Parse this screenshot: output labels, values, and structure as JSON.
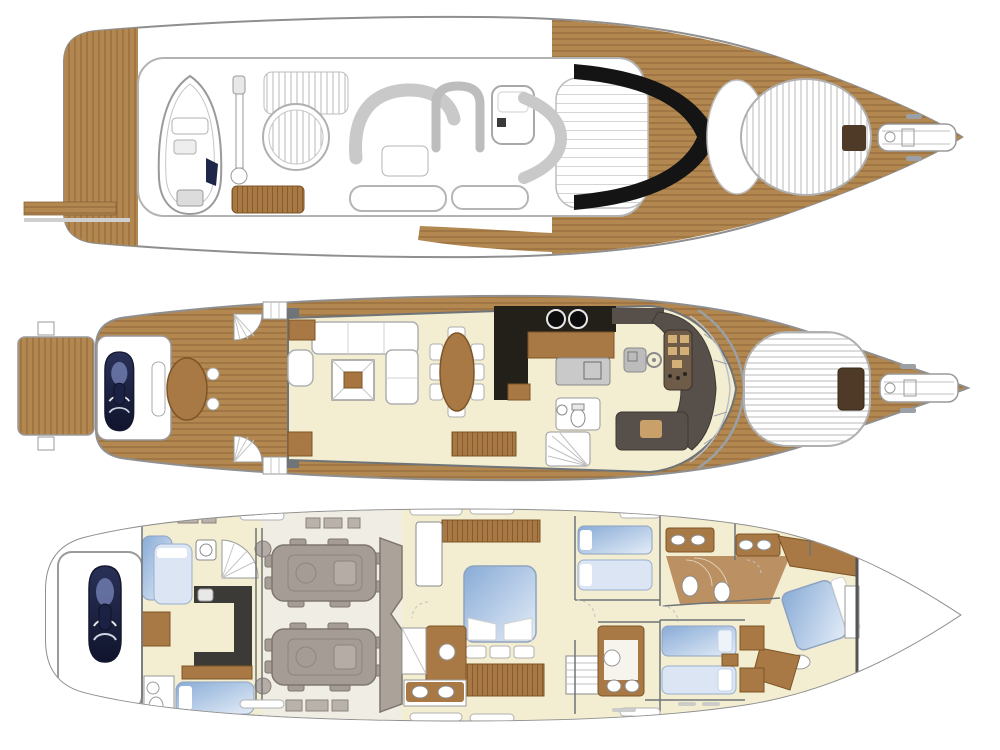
{
  "figure": {
    "type": "yacht-deck-plan-triptych",
    "views": [
      {
        "id": "top-exterior",
        "label": "Flybridge and exterior top view",
        "features": [
          "tender-boat",
          "davit-crane",
          "spa-pool",
          "sun-pad",
          "u-settee",
          "lounge-seating",
          "wet-bar",
          "teak-bench",
          "black-windscreen",
          "foredeck-sun-pad",
          "deck-hatch",
          "anchor-windlass",
          "mooring-cleats",
          "passerelle",
          "teak-side-decks"
        ]
      },
      {
        "id": "main-deck",
        "label": "Main deck",
        "features": [
          "swim-platform",
          "jet-ski-garage",
          "cockpit-teak-table",
          "fan-stairs",
          "boarding-steps",
          "salon-l-sofa",
          "armchair",
          "coffee-table",
          "side-tables",
          "oval-dining-table",
          "eight-dining-chairs",
          "sideboard",
          "galley-counter",
          "two-burner-cooktop",
          "refrigerator",
          "companionway-stairs",
          "day-head",
          "helm-console",
          "instrument-panel",
          "steering-wheel",
          "companion-seat",
          "windscreen",
          "foredeck-sun-pad",
          "deck-hatch",
          "anchor-windlass",
          "mooring-cleats"
        ]
      },
      {
        "id": "lower-deck",
        "label": "Lower deck",
        "features": [
          "jet-ski-garage",
          "crew-bunks",
          "crew-berth",
          "crew-mess-counters",
          "crew-bathroom",
          "spiral-staircase",
          "washer",
          "engine-room",
          "twin-engines",
          "generator-blocks",
          "fuel-tank-bulkhead",
          "master-cabin-double-bed",
          "master-wardrobe",
          "master-vanity",
          "master-dressers",
          "master-ensuite-twin-basins",
          "shower",
          "aft-twin-guest-cabin",
          "guest-bathrooms",
          "mid-bathroom",
          "forward-twin-guest-cabin",
          "vip-cabin-angled-double-bed",
          "vip-wardrobe",
          "companionway-stairs",
          "collision-bulkhead",
          "hull-window-slots"
        ]
      }
    ]
  },
  "counts": {
    "deck_views": 3,
    "dining_chairs": 8,
    "engines": 2,
    "cooktop_burners": 2,
    "master_ensuite_basins": 2
  },
  "palette": {
    "paper": "#ffffff",
    "hull-line": "#8f8f8f",
    "light-line": "#c6c6c6",
    "wall": "#6f7478",
    "teak": "#b28750",
    "teak-line": "#8a6336",
    "cream": "#f3eed2",
    "furn-brown": "#a87944",
    "furn-brown-dark": "#7d5526",
    "counter-black": "#232019",
    "helm-charcoal": "#57504a",
    "helm-panel": "#6e5b48",
    "instrument-tan": "#d2b078",
    "glass-black": "#141414",
    "bed-blue": "#88abd6",
    "bed-blue-light": "#dbe5f3",
    "engine-gray": "#a59d95",
    "engine-gray-dark": "#7e766e",
    "tank-gray": "#aba29a",
    "jetski-navy": "#20264a",
    "fixture-gray": "#9a9a9a",
    "hatch-brown": "#4e3a26"
  }
}
